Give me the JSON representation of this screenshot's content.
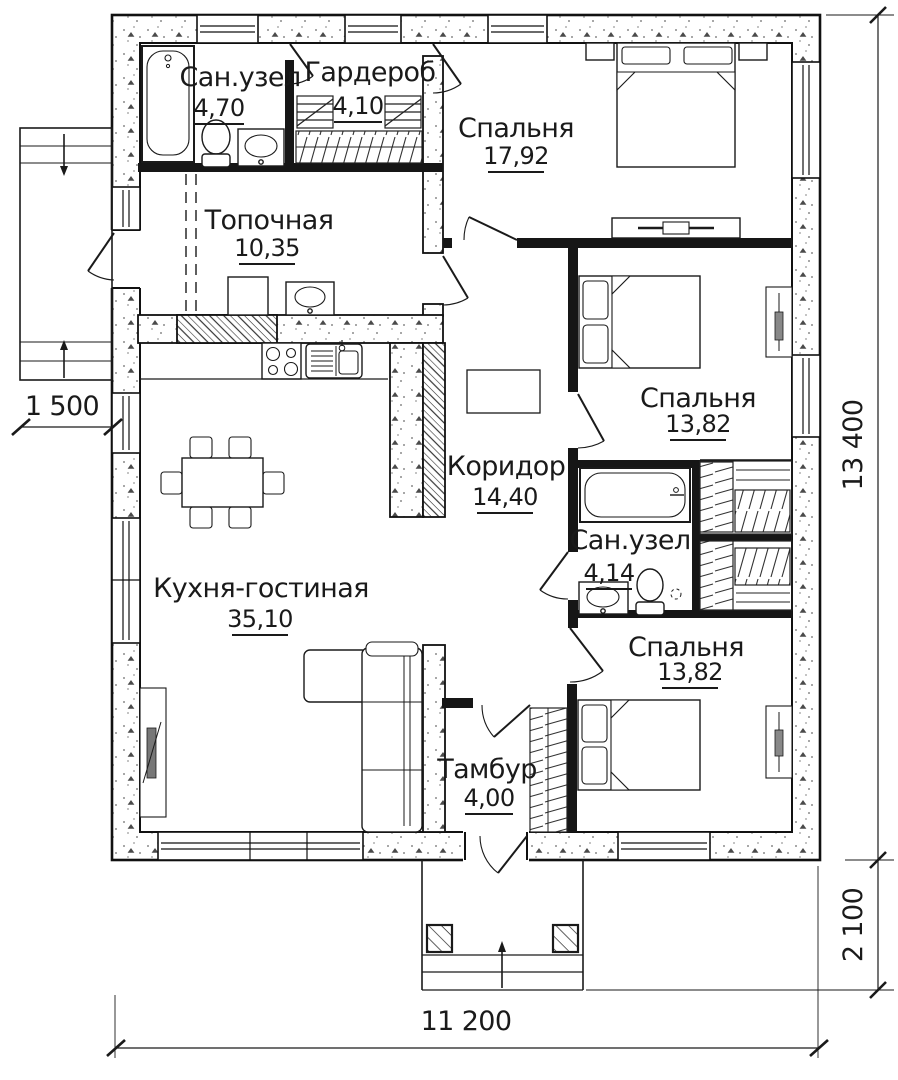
{
  "plan": {
    "rooms": [
      {
        "id": "bathroom-1",
        "name": "Сан.узел",
        "area": "4,70"
      },
      {
        "id": "wardrobe",
        "name": "Гардероб",
        "area": "4,10"
      },
      {
        "id": "bedroom-1",
        "name": "Спальня",
        "area": "17,92"
      },
      {
        "id": "boiler-room",
        "name": "Топочная",
        "area": "10,35"
      },
      {
        "id": "bedroom-2",
        "name": "Спальня",
        "area": "13,82"
      },
      {
        "id": "corridor",
        "name": "Коридор",
        "area": "14,40"
      },
      {
        "id": "bathroom-2",
        "name": "Сан.узел",
        "area": "4,14"
      },
      {
        "id": "kitchen-living",
        "name": "Кухня-гостиная",
        "area": "35,10"
      },
      {
        "id": "bedroom-3",
        "name": "Спальня",
        "area": "13,82"
      },
      {
        "id": "vestibule",
        "name": "Тамбур",
        "area": "4,00"
      }
    ],
    "dimensions": {
      "left_porch_width": "1 500",
      "house_height": "13 400",
      "porch_depth": "2 100",
      "house_width": "11 200"
    },
    "colors": {
      "line": "#1a1a1a",
      "background": "#ffffff"
    }
  }
}
